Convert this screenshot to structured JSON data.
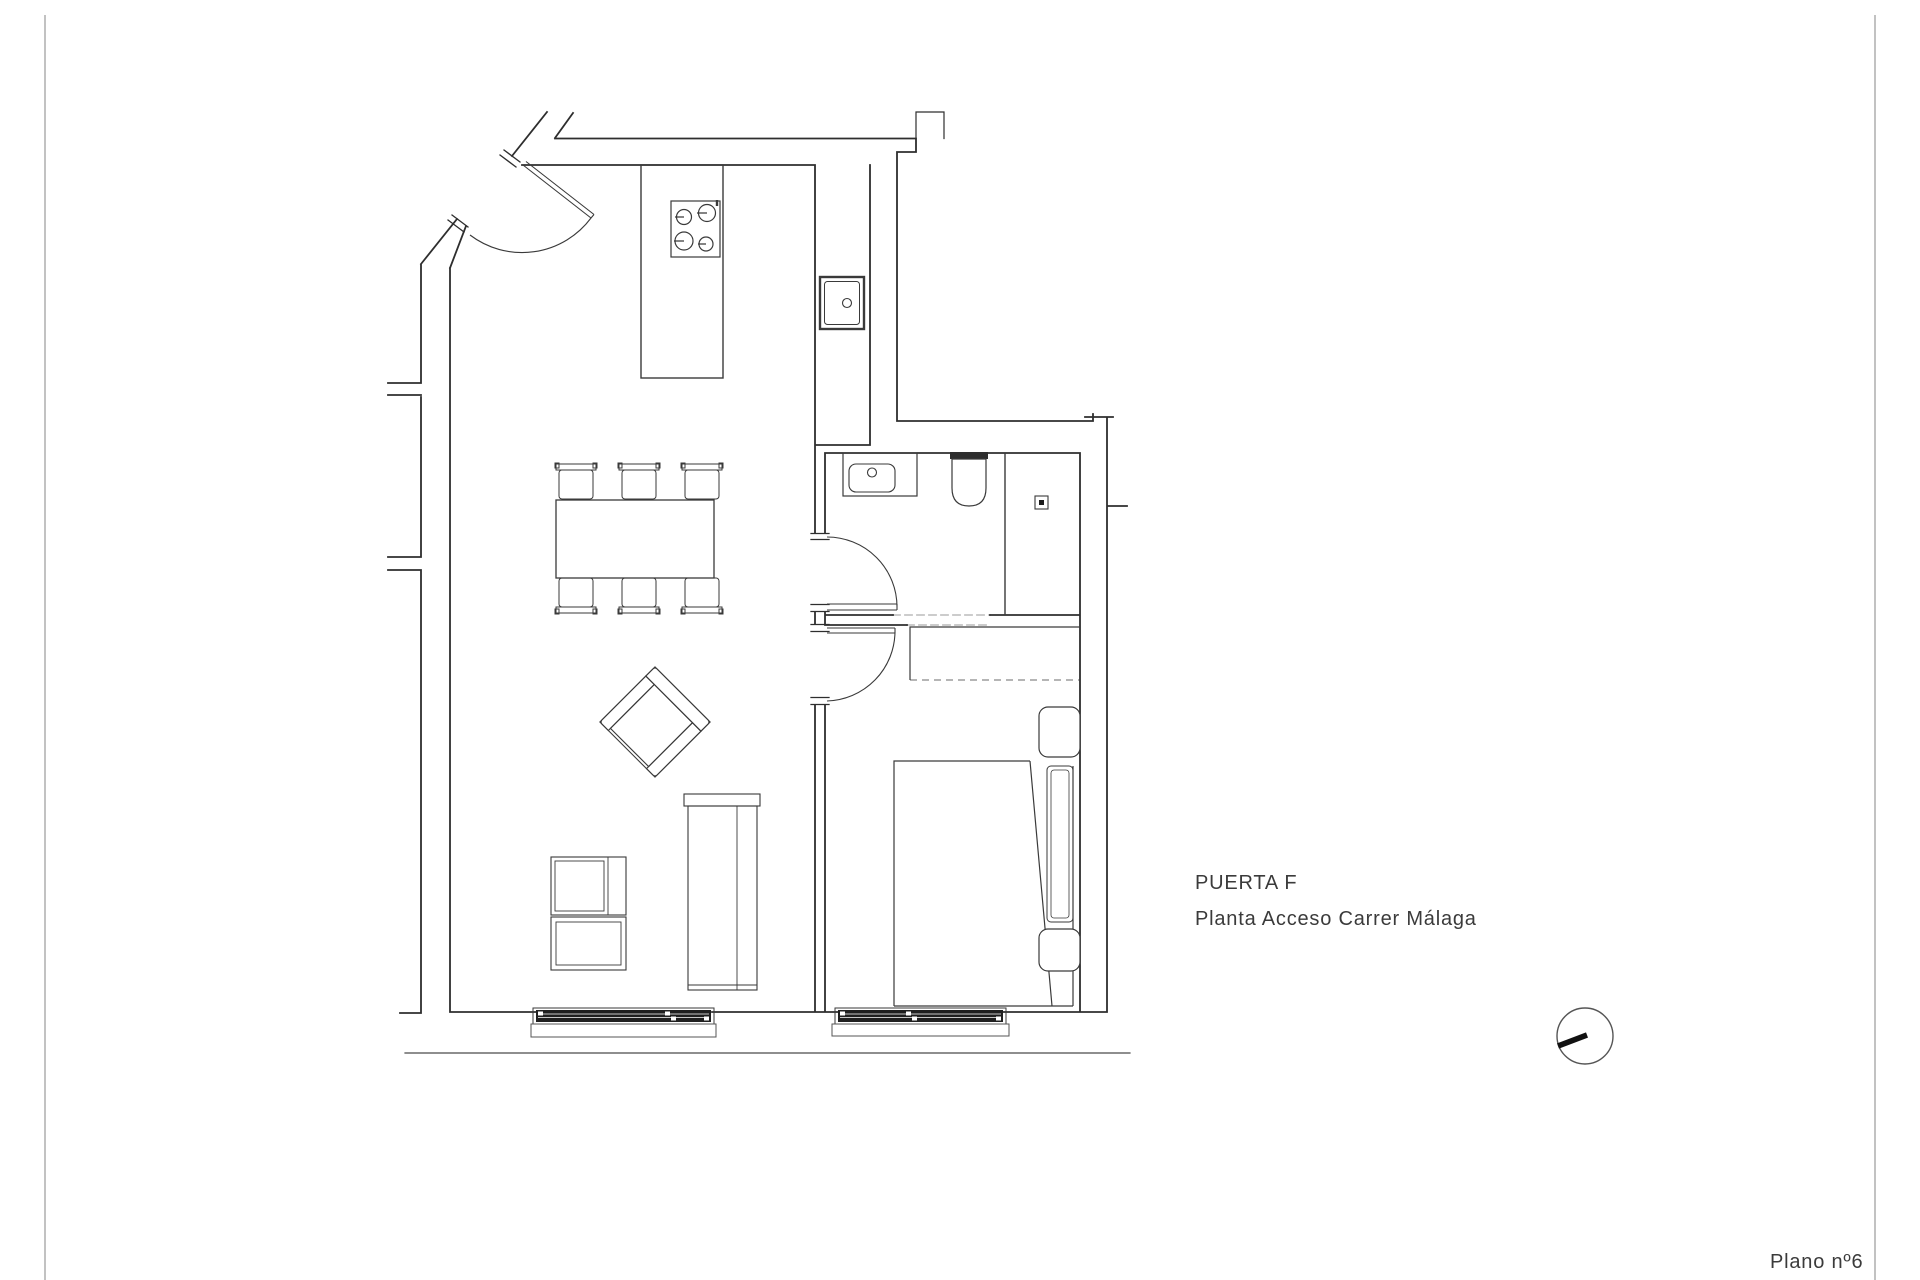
{
  "sheet": {
    "labels": {
      "unit": "PUERTA F",
      "floor": "Planta Acceso Carrer Málaga",
      "number": "Plano nº6"
    },
    "colors": {
      "line": "#2e2e2e",
      "text": "#3b3b3b",
      "window_fill": "#1f1f1f",
      "border": "#9a9a9a",
      "background": "#ffffff"
    },
    "north_indicator": {
      "cx": "1585",
      "cy": "1036",
      "r": "28"
    }
  },
  "plan": {
    "fixtures": [
      "entry-door",
      "kitchen-island",
      "cooktop-4-burners",
      "kitchen-sink",
      "bathroom-vanity",
      "toilet",
      "shower-drain",
      "bathroom-door",
      "bedroom-door",
      "wardrobe",
      "double-bed",
      "nightstand-upper",
      "nightstand-lower",
      "dining-table",
      "dining-chairs-6",
      "armchair",
      "sideboard",
      "tv-unit",
      "living-window",
      "bedroom-window"
    ]
  }
}
